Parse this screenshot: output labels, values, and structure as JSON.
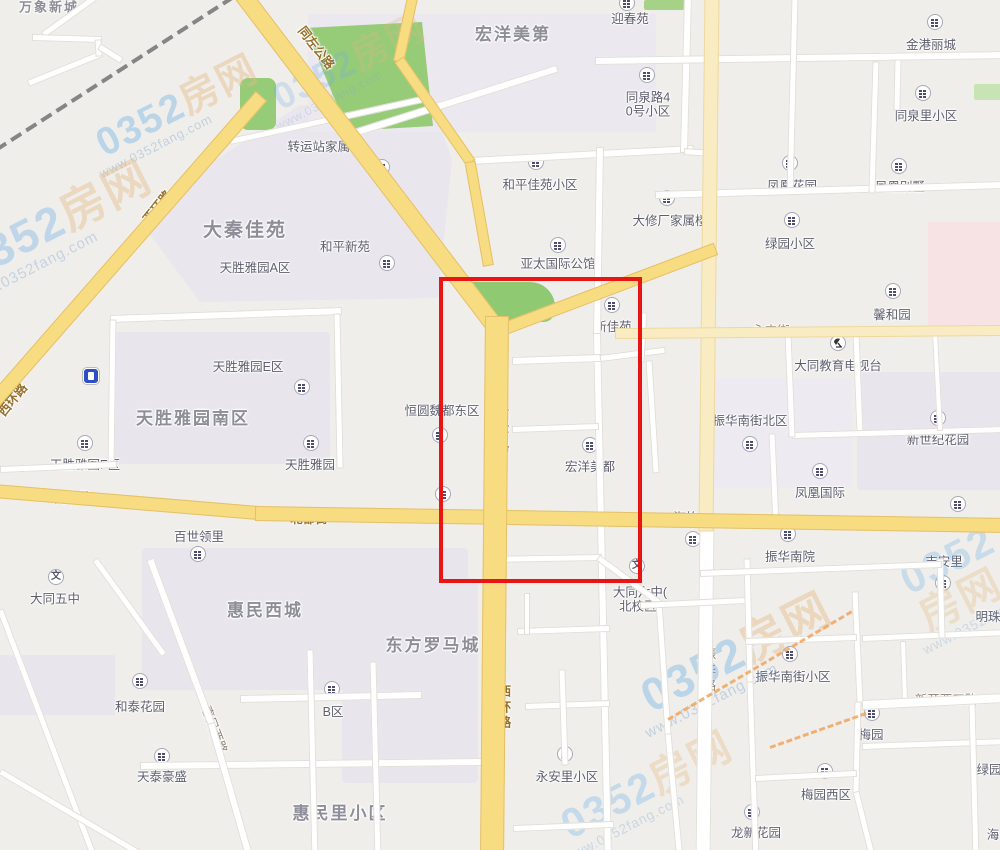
{
  "map": {
    "background_color": "#F0EEEB",
    "highlight_box": {
      "x": 439,
      "y": 277,
      "width": 195,
      "height": 298,
      "color": "#E91414"
    },
    "watermark": {
      "brand_number": "0352",
      "brand_word": "房网",
      "url": "www.0352fang.com"
    },
    "district_labels": [
      {
        "text": "万象新城",
        "x": 49,
        "y": 8,
        "size": 13
      },
      {
        "text": "宏洋美第",
        "x": 513,
        "y": 35,
        "size": 17
      },
      {
        "text": "大秦佳苑",
        "x": 245,
        "y": 231,
        "size": 19
      },
      {
        "text": "天胜雅园南区",
        "x": 193,
        "y": 419,
        "size": 17
      },
      {
        "text": "惠民西城",
        "x": 265,
        "y": 611,
        "size": 17
      },
      {
        "text": "东方罗马城",
        "x": 433,
        "y": 646,
        "size": 17
      },
      {
        "text": "惠民里小区",
        "x": 340,
        "y": 814,
        "size": 17
      }
    ],
    "place_labels": [
      {
        "text": "迎春苑",
        "x": 630,
        "y": 19
      },
      {
        "text": "金港丽城",
        "x": 931,
        "y": 45
      },
      {
        "lines": [
          "同泉路4",
          "0号小区"
        ],
        "text": "同泉路40号小区",
        "x": 648,
        "y": 105
      },
      {
        "text": "同泉里小区",
        "x": 926,
        "y": 116
      },
      {
        "text": "转运站家属楼",
        "x": 325,
        "y": 147
      },
      {
        "text": "和平佳苑小区",
        "x": 540,
        "y": 185
      },
      {
        "text": "凤凰花园",
        "x": 792,
        "y": 186
      },
      {
        "text": "凤凰别墅",
        "x": 900,
        "y": 187
      },
      {
        "text": "大修厂家属楼",
        "x": 670,
        "y": 221
      },
      {
        "text": "绿园小区",
        "x": 790,
        "y": 244
      },
      {
        "text": "和平新苑",
        "x": 345,
        "y": 247
      },
      {
        "text": "亚太国际公馆",
        "x": 558,
        "y": 264
      },
      {
        "text": "天胜雅园A区",
        "x": 255,
        "y": 268
      },
      {
        "text": "馨和园",
        "x": 892,
        "y": 315
      },
      {
        "text": "新佳苑",
        "x": 613,
        "y": 327
      },
      {
        "text": "大同教育电视台",
        "x": 838,
        "y": 366
      },
      {
        "text": "天胜雅园E区",
        "x": 248,
        "y": 367
      },
      {
        "text": "恒圆魏都东区",
        "x": 442,
        "y": 411
      },
      {
        "text": "振华南街北区",
        "x": 750,
        "y": 421
      },
      {
        "text": "新世纪花园",
        "x": 938,
        "y": 440
      },
      {
        "text": "天胜雅园F区",
        "x": 85,
        "y": 465
      },
      {
        "text": "天胜雅园",
        "x": 310,
        "y": 465
      },
      {
        "text": "宏洋美都",
        "x": 590,
        "y": 467
      },
      {
        "text": "凤凰国际",
        "x": 820,
        "y": 493
      },
      {
        "text": "宏洋财富中心",
        "x": 445,
        "y": 517
      },
      {
        "text": "海怡居",
        "x": 692,
        "y": 518
      },
      {
        "text": "新世纪南苑",
        "x": 955,
        "y": 525
      },
      {
        "text": "百世领里",
        "x": 199,
        "y": 537
      },
      {
        "text": "振华南院",
        "x": 790,
        "y": 557
      },
      {
        "text": "吉安里",
        "x": 944,
        "y": 562
      },
      {
        "text": "大同五中",
        "x": 55,
        "y": 599
      },
      {
        "lines": [
          "大同六中(",
          "北校区)"
        ],
        "text": "大同六中(北校区)",
        "x": 640,
        "y": 600
      },
      {
        "text": "振华南街小区",
        "x": 793,
        "y": 677
      },
      {
        "text": "和泰花园",
        "x": 140,
        "y": 707
      },
      {
        "text": "B区",
        "x": 333,
        "y": 712
      },
      {
        "text": "明珠",
        "x": 988,
        "y": 617
      },
      {
        "text": "梅园",
        "x": 871,
        "y": 735
      },
      {
        "text": "永安里小区",
        "x": 567,
        "y": 777
      },
      {
        "text": "天泰豪盛",
        "x": 162,
        "y": 777
      },
      {
        "text": "绿园",
        "x": 989,
        "y": 770
      },
      {
        "text": "梅园西区",
        "x": 826,
        "y": 795
      },
      {
        "text": "龙新花园",
        "x": 756,
        "y": 833
      },
      {
        "text": "海",
        "x": 993,
        "y": 835
      }
    ],
    "road_labels": [
      {
        "text": "同左公路",
        "x": 316,
        "y": 48,
        "rotate": 52,
        "style": "roadname"
      },
      {
        "text": "西环路",
        "x": 158,
        "y": 207,
        "rotate": -51,
        "style": "roadname"
      },
      {
        "text": "西环路",
        "x": 13,
        "y": 400,
        "rotate": -51,
        "style": "roadname"
      },
      {
        "text": "西环路",
        "x": 503,
        "y": 432,
        "vertical": true,
        "style": "roadname"
      },
      {
        "text": "西环路",
        "x": 505,
        "y": 708,
        "vertical": true,
        "style": "roadname"
      },
      {
        "text": "同泉路",
        "x": 73,
        "y": 498,
        "style": "roadname"
      },
      {
        "text": "北都街",
        "x": 309,
        "y": 519,
        "style": "roadname"
      },
      {
        "text": "北都街",
        "x": 627,
        "y": 520,
        "style": "roadname"
      },
      {
        "text": "永宁街",
        "x": 771,
        "y": 331,
        "style": "roadgray"
      },
      {
        "text": "振华路",
        "x": 710,
        "y": 671,
        "vertical": true,
        "style": "roadgray"
      },
      {
        "text": "惠民西路",
        "x": 214,
        "y": 730,
        "rotate": 69,
        "style": "roadgray"
      },
      {
        "text": "新开西三路",
        "x": 946,
        "y": 700,
        "style": "roadgray"
      }
    ],
    "poi_icons": [
      {
        "type": "residence",
        "x": 627,
        "y": 3
      },
      {
        "type": "residence",
        "x": 935,
        "y": 22
      },
      {
        "type": "residence",
        "x": 647,
        "y": 75
      },
      {
        "type": "residence",
        "x": 923,
        "y": 93
      },
      {
        "type": "residence",
        "x": 790,
        "y": 163
      },
      {
        "type": "residence",
        "x": 899,
        "y": 166
      },
      {
        "type": "residence",
        "x": 536,
        "y": 162
      },
      {
        "type": "residence",
        "x": 382,
        "y": 167
      },
      {
        "type": "residence",
        "x": 667,
        "y": 198
      },
      {
        "type": "residence",
        "x": 792,
        "y": 220
      },
      {
        "type": "residence",
        "x": 558,
        "y": 245
      },
      {
        "type": "residence",
        "x": 387,
        "y": 263
      },
      {
        "type": "residence",
        "x": 893,
        "y": 291
      },
      {
        "type": "residence",
        "x": 612,
        "y": 305
      },
      {
        "type": "gas-station",
        "x": 91,
        "y": 376
      },
      {
        "type": "residence",
        "x": 302,
        "y": 387
      },
      {
        "type": "residence",
        "x": 938,
        "y": 418
      },
      {
        "type": "residence",
        "x": 440,
        "y": 435
      },
      {
        "type": "residence",
        "x": 85,
        "y": 443
      },
      {
        "type": "residence",
        "x": 311,
        "y": 443
      },
      {
        "type": "residence",
        "x": 750,
        "y": 444
      },
      {
        "type": "residence",
        "x": 590,
        "y": 445
      },
      {
        "type": "residence",
        "x": 820,
        "y": 471
      },
      {
        "type": "residence",
        "x": 443,
        "y": 494
      },
      {
        "type": "residence",
        "x": 958,
        "y": 504
      },
      {
        "type": "residence",
        "x": 788,
        "y": 534
      },
      {
        "type": "residence",
        "x": 693,
        "y": 539
      },
      {
        "type": "residence",
        "x": 198,
        "y": 554
      },
      {
        "type": "school",
        "x": 56,
        "y": 577
      },
      {
        "type": "school",
        "x": 637,
        "y": 566
      },
      {
        "type": "residence",
        "x": 943,
        "y": 583
      },
      {
        "type": "tv-station",
        "x": 838,
        "y": 343
      },
      {
        "type": "residence",
        "x": 140,
        "y": 681
      },
      {
        "type": "residence",
        "x": 332,
        "y": 689
      },
      {
        "type": "residence",
        "x": 790,
        "y": 654
      },
      {
        "type": "residence",
        "x": 872,
        "y": 713
      },
      {
        "type": "residence",
        "x": 565,
        "y": 754
      },
      {
        "type": "residence",
        "x": 162,
        "y": 756
      },
      {
        "type": "residence",
        "x": 825,
        "y": 771
      },
      {
        "type": "residence",
        "x": 752,
        "y": 812
      }
    ]
  }
}
